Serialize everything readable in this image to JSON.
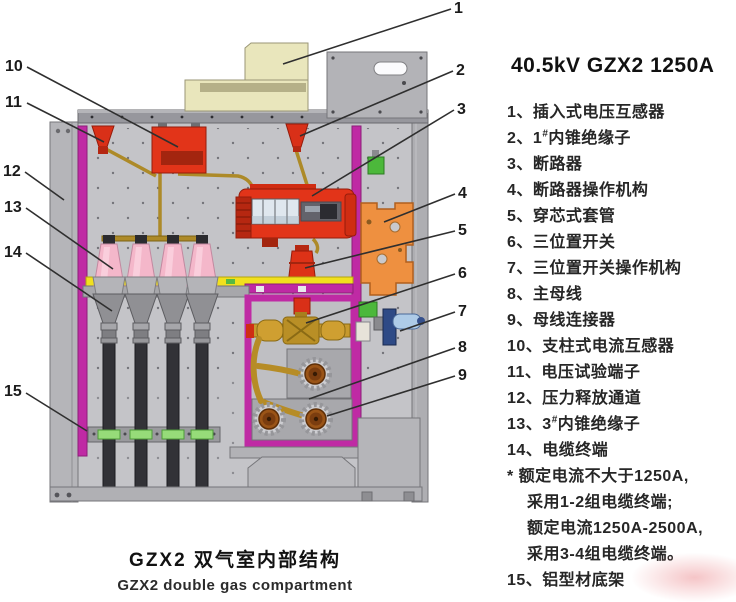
{
  "header": {
    "title": "40.5kV GZX2 1250A"
  },
  "legend": {
    "items": [
      {
        "text": "1、插入式电压互感器"
      },
      {
        "text": "2、1#内锥绝缘子"
      },
      {
        "text": "3、断路器"
      },
      {
        "text": "4、断路器操作机构"
      },
      {
        "text": "5、穿芯式套管"
      },
      {
        "text": "6、三位置开关"
      },
      {
        "text": "7、三位置开关操作机构"
      },
      {
        "text": "8、主母线"
      },
      {
        "text": "9、母线连接器"
      },
      {
        "text": "10、支柱式电流互感器"
      },
      {
        "text": "11、电压试验端子"
      },
      {
        "text": "12、压力释放通道"
      },
      {
        "text": "13、3#内锥绝缘子"
      },
      {
        "text": "14、电缆终端"
      },
      {
        "text": "* 额定电流不大于1250A,"
      },
      {
        "text": "采用1-2组电缆终端;",
        "indent": true
      },
      {
        "text": "额定电流1250A-2500A,",
        "indent": true
      },
      {
        "text": "采用3-4组电缆终端。",
        "indent": true
      },
      {
        "text": "15、铝型材底架"
      }
    ]
  },
  "caption": {
    "line1": "GZX2 双气室内部结构",
    "line2": "GZX2 double gas compartment"
  },
  "callouts": [
    {
      "n": "1",
      "label_x": 454,
      "label_y": 0,
      "x1": 451,
      "y1": 9,
      "x2": 283,
      "y2": 64
    },
    {
      "n": "2",
      "label_x": 456,
      "label_y": 62,
      "x1": 453,
      "y1": 71,
      "x2": 300,
      "y2": 136
    },
    {
      "n": "3",
      "label_x": 457,
      "label_y": 101,
      "x1": 454,
      "y1": 110,
      "x2": 312,
      "y2": 196
    },
    {
      "n": "4",
      "label_x": 458,
      "label_y": 185,
      "x1": 455,
      "y1": 194,
      "x2": 384,
      "y2": 222
    },
    {
      "n": "5",
      "label_x": 458,
      "label_y": 222,
      "x1": 455,
      "y1": 231,
      "x2": 305,
      "y2": 268
    },
    {
      "n": "6",
      "label_x": 458,
      "label_y": 265,
      "x1": 455,
      "y1": 274,
      "x2": 306,
      "y2": 323
    },
    {
      "n": "7",
      "label_x": 458,
      "label_y": 303,
      "x1": 455,
      "y1": 312,
      "x2": 400,
      "y2": 331
    },
    {
      "n": "8",
      "label_x": 458,
      "label_y": 339,
      "x1": 455,
      "y1": 348,
      "x2": 309,
      "y2": 399
    },
    {
      "n": "9",
      "label_x": 458,
      "label_y": 367,
      "x1": 455,
      "y1": 376,
      "x2": 327,
      "y2": 416
    },
    {
      "n": "10",
      "label_x": 5,
      "label_y": 58,
      "x1": 27,
      "y1": 67,
      "x2": 178,
      "y2": 147
    },
    {
      "n": "11",
      "label_x": 5,
      "label_y": 94,
      "x1": 27,
      "y1": 103,
      "x2": 104,
      "y2": 142
    },
    {
      "n": "12",
      "label_x": 3,
      "label_y": 163,
      "x1": 25,
      "y1": 172,
      "x2": 64,
      "y2": 200
    },
    {
      "n": "13",
      "label_x": 4,
      "label_y": 199,
      "x1": 26,
      "y1": 208,
      "x2": 113,
      "y2": 269
    },
    {
      "n": "14",
      "label_x": 4,
      "label_y": 244,
      "x1": 26,
      "y1": 253,
      "x2": 112,
      "y2": 311
    },
    {
      "n": "15",
      "label_x": 4,
      "label_y": 383,
      "x1": 26,
      "y1": 393,
      "x2": 87,
      "y2": 431
    }
  ],
  "colors": {
    "magenta": "#bf2aa4",
    "red": "#e23419",
    "orange": "#ee9040",
    "cream": "#e9e6bc",
    "pink_insulator": "#f4b7ca",
    "brass": "#ad8a28",
    "yellow": "#f1e01e",
    "green": "#4cb83b",
    "blue": "#aecbe7",
    "cabinet_grey": "#c4c4c8",
    "cable_dark": "#323237"
  }
}
